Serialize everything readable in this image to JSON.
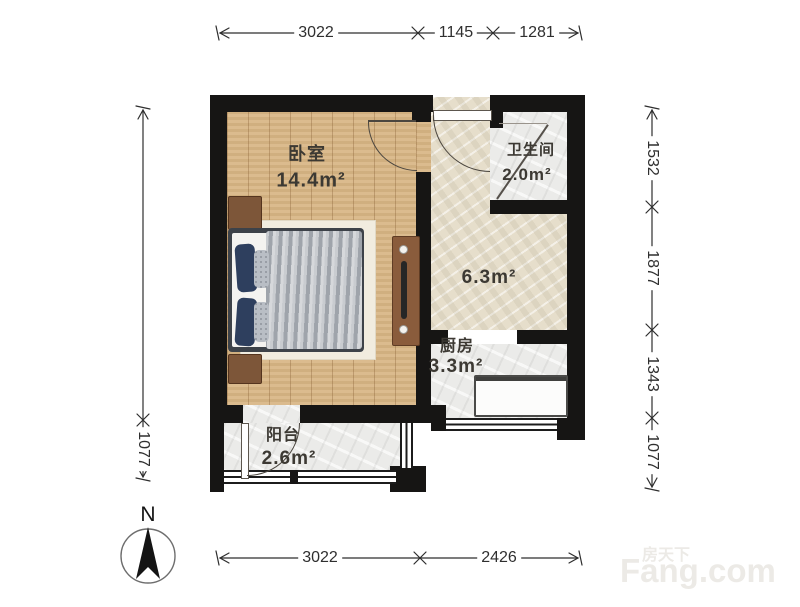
{
  "rooms": {
    "bedroom": {
      "name": "卧室",
      "area": "14.4m²"
    },
    "bathroom": {
      "name": "卫生间",
      "area": "2.0m²"
    },
    "hall": {
      "area": "6.3m²"
    },
    "kitchen": {
      "name": "厨房",
      "area": "3.3m²"
    },
    "balcony": {
      "name": "阳台",
      "area": "2.6m²"
    }
  },
  "dimensions": {
    "top": {
      "d1": "3022",
      "d2": "1145",
      "d3": "1281"
    },
    "bottom": {
      "d1": "3022",
      "d2": "2426"
    },
    "right": {
      "d1": "1532",
      "d2": "1877",
      "d3": "1343",
      "d4": "1077"
    },
    "left": {
      "d1": "1077"
    }
  },
  "compass": {
    "north_label": "N"
  },
  "watermark": {
    "cn": "房天下",
    "en": "Fang.com"
  },
  "colors": {
    "wall": "#161514",
    "wood_floor": "#d8b584",
    "stone_floor": "#e6decb",
    "tile_floor": "#ebebe9"
  }
}
